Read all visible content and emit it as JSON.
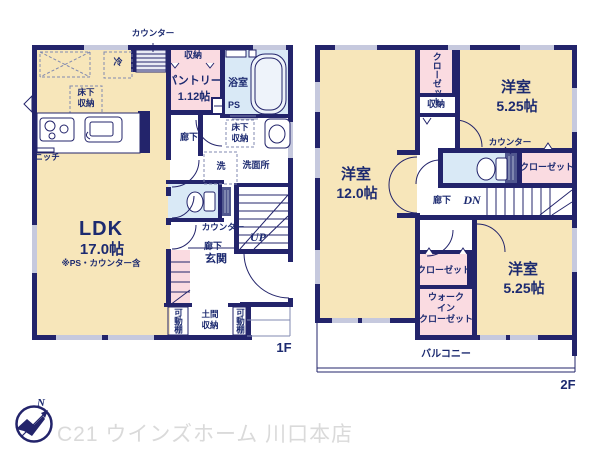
{
  "meta": {
    "floor1_label": "1F",
    "floor2_label": "2F",
    "compass_n": "N",
    "watermark": "C21 ウインズホーム 川口本店"
  },
  "colors": {
    "wall": "#23246b",
    "room_tan": "#f7e6ba",
    "closet_pink": "#fadbe1",
    "wet_blue": "#d9e9f6",
    "window_gray": "#c6c9de",
    "label_navy": "#1c2a70",
    "watermark_gray": "#dadada"
  },
  "floor1": {
    "counter_top": "カウンター",
    "fridge": "冷",
    "underfloor_1": "床下",
    "underfloor_2": "収納",
    "niche": "ニッチ",
    "ldk_name": "LDK",
    "ldk_size": "17.0帖",
    "ldk_note": "※PS・カウンター含",
    "storage": "収納",
    "pantry_name": "パントリー",
    "pantry_size": "1.12帖",
    "ps": "PS",
    "bath": "浴室",
    "wash_underfloor_1": "床下",
    "wash_underfloor_2": "収納",
    "washer": "洗",
    "washroom": "洗面所",
    "hallway_upper": "廊下",
    "counter_mid": "カウンター",
    "up": "UP",
    "hallway_lower": "廊下",
    "entrance": "玄関",
    "shelf_left": "可動棚",
    "doma_1": "土間",
    "doma_2": "収納",
    "shelf_right": "可動棚"
  },
  "floor2": {
    "closet_top": "クローゼット",
    "storage": "収納",
    "room_tr_name": "洋室",
    "room_tr_size": "5.25帖",
    "counter": "カウンター",
    "closet_right": "クローゼット",
    "room_left_name": "洋室",
    "room_left_size": "12.0帖",
    "hallway": "廊下",
    "dn": "DN",
    "closet_bl": "クローゼット",
    "wic_1": "ウォーク",
    "wic_2": "イン",
    "wic_3": "クローゼット",
    "room_br_name": "洋室",
    "room_br_size": "5.25帖",
    "balcony": "バルコニー"
  }
}
